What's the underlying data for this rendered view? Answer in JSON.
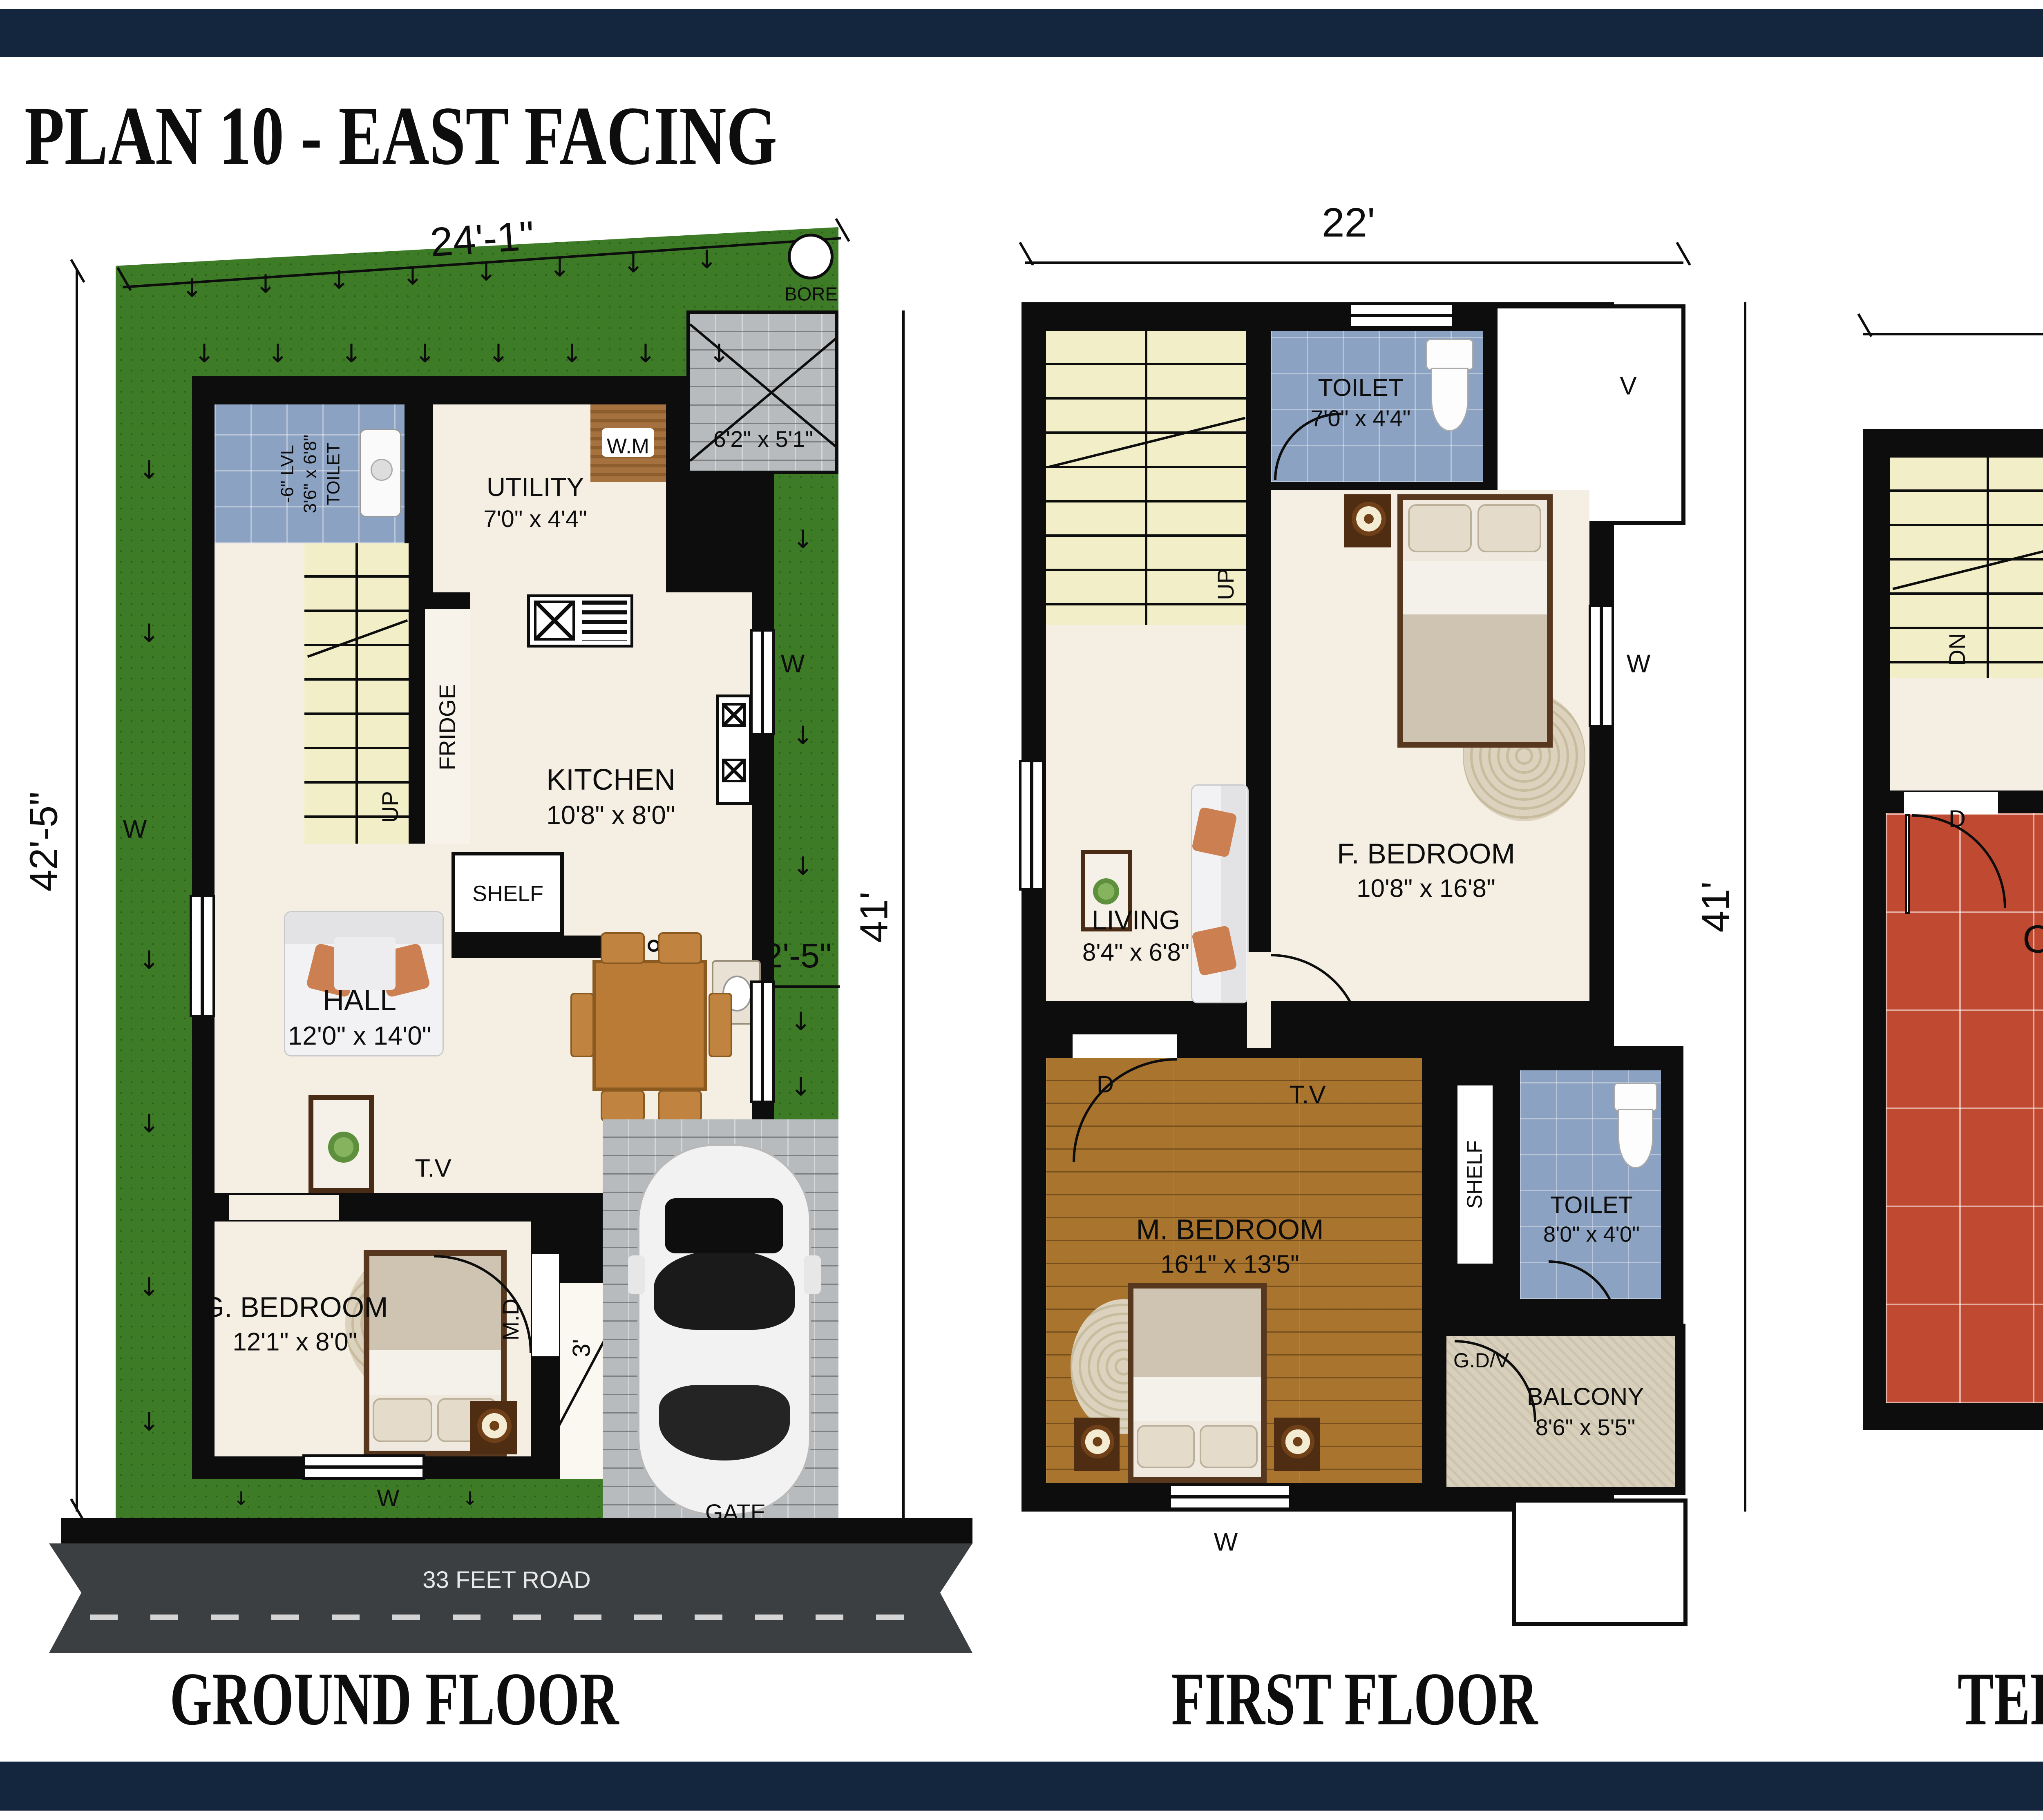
{
  "title": "PLAN 10 - EAST FACING",
  "icons": {
    "arrow_down": "↓"
  },
  "ground": {
    "label": "GROUND FLOOR",
    "dim_top": "24'-1\"",
    "dim_left": "42'-5\"",
    "dim_right": "41'",
    "dim_strip": "2'-5\"",
    "dim_porch": "3'",
    "bore": "BORE",
    "toilet_lvl": "-6\" LVL",
    "toilet_size": "3'6\" x 6'8\"",
    "toilet_name": "TOILET",
    "pd": "P.D",
    "utility_name": "UTILITY",
    "utility_size": "7'0\" x 4'4\"",
    "wm": "W.M",
    "pad_size": "6'2\" x 5'1\"",
    "up": "UP",
    "fridge": "FRIDGE",
    "kitchen_name": "KITCHEN",
    "kitchen_size": "10'8\" x 8'0\"",
    "shelf": "SHELF",
    "hall_name": "HALL",
    "hall_size": "12'0\" x 14'0\"",
    "dining_name": "DINING",
    "dining_size": "6'0\" x 8'3\"",
    "md": "M.D",
    "tv": "T.V",
    "gbed_name": "G. BEDROOM",
    "gbed_size": "12'1\" x 8'0\"",
    "portico_name": "PORTICO",
    "portico_size": "8'0\" x 15'0\"",
    "gate": "GATE",
    "road": "33 FEET ROAD",
    "w": "W"
  },
  "first": {
    "label": "FIRST FLOOR",
    "dim_top": "22'",
    "dim_right": "41'",
    "toilet1_name": "TOILET",
    "toilet1_size": "7'0\" x 4'4\"",
    "v": "V",
    "pd": "P.D",
    "up": "UP",
    "living_name": "LIVING",
    "living_size": "8'4\" x 6'8\"",
    "fbed_name": "F. BEDROOM",
    "fbed_size": "10'8\" x 16'8\"",
    "d": "D",
    "tv": "T.V",
    "mbed_name": "M. BEDROOM",
    "mbed_size": "16'1\" x 13'5\"",
    "shelf": "SHELF",
    "toilet2_name": "TOILET",
    "toilet2_size": "8'0\" x 4'0\"",
    "gdv": "G.D/V",
    "balcony_name": "BALCONY",
    "balcony_size": "8'6\" x 5'5\"",
    "w": "W"
  },
  "terrace": {
    "label": "TERRACE FLOOR",
    "dim_top": "22'",
    "dn": "DN",
    "d": "D",
    "open_terrace": "OPEN TERRACE"
  }
}
